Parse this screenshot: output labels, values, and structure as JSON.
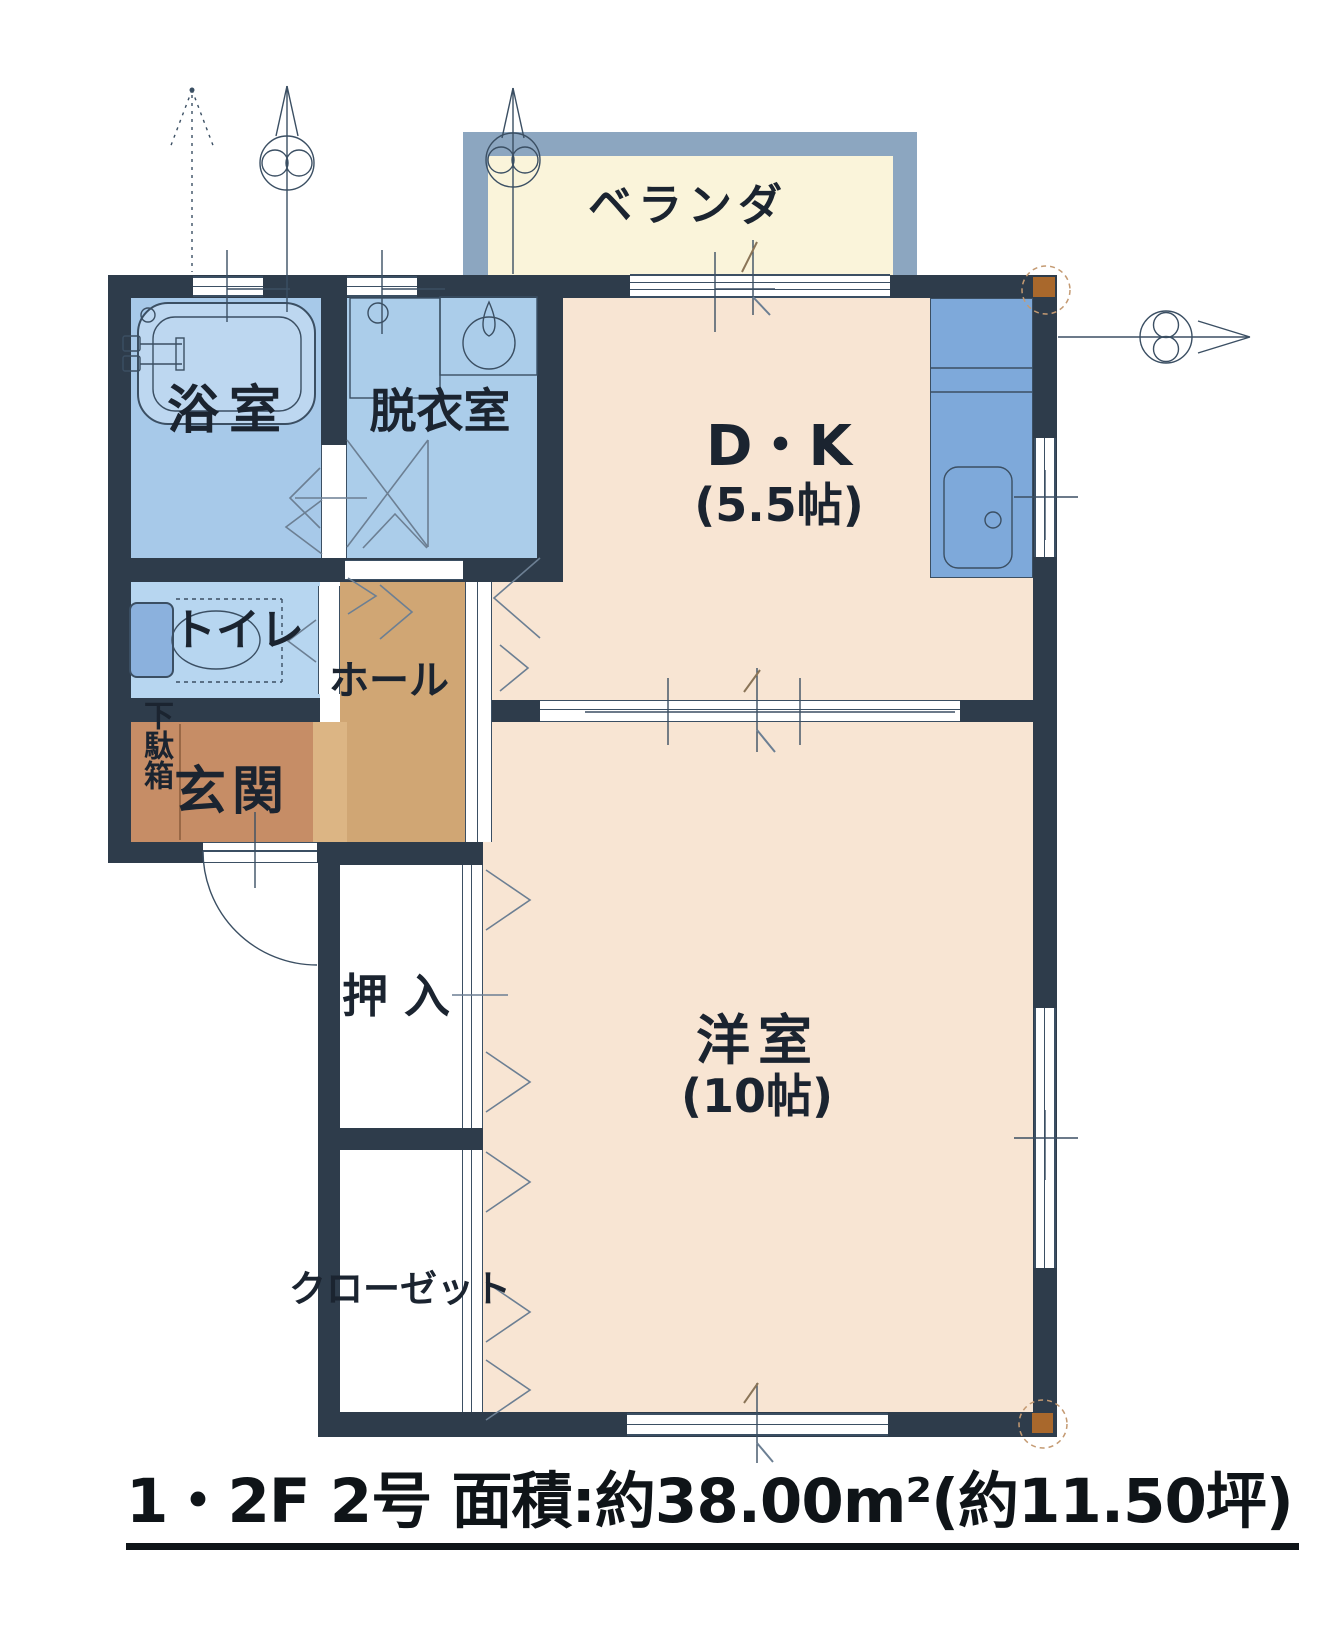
{
  "footer": {
    "title": "1・2F 2号 面積:約38.00m²(約11.50坪)"
  },
  "rooms": {
    "veranda": {
      "label": "ベランダ"
    },
    "dining_kitchen": {
      "label": "D・K",
      "size": "(5.5帖)"
    },
    "bathroom": {
      "label": "浴室"
    },
    "dressing_room": {
      "label": "脱衣室"
    },
    "toilet": {
      "label": "トイレ"
    },
    "hall": {
      "label": "ホール"
    },
    "entrance": {
      "label": "玄関"
    },
    "shoe_cabinet": {
      "label": "下駄箱"
    },
    "oshiire": {
      "label": "押入"
    },
    "closet": {
      "label": "クローゼット"
    },
    "western_room": {
      "label": "洋室",
      "size": "(10帖)"
    }
  },
  "symbols": [
    "bathtub-icon",
    "washing-machine-pan-icon",
    "vanity-sink-icon",
    "toilet-icon",
    "kitchen-sink-icon",
    "entrance-door-swing",
    "section-arrow-up-dashed",
    "section-arrow-up-1",
    "section-arrow-up-2",
    "section-arrow-right",
    "pillar-marker"
  ],
  "colors": {
    "wall": "#2e3c4b",
    "line": "#3b4f63",
    "ink": "#1b2430",
    "bath": "#a7c9e9",
    "dressing": "#abcdea",
    "toiletfloor": "#b7d6f0",
    "tub": "#bdd7f0",
    "fixture": "#d5e3f4",
    "sinkblock": "#8bb1dd",
    "counter": "#7ea9da",
    "countersink": "#bcd6ef",
    "room": "#f8e5d3",
    "hallfloor": "#d0a674",
    "entrancefloor": "#c68d66",
    "step": "#dcb584",
    "verandaframe": "#8ca6c0",
    "verandafloor": "#faf4da",
    "pillar": "#a9682c"
  }
}
